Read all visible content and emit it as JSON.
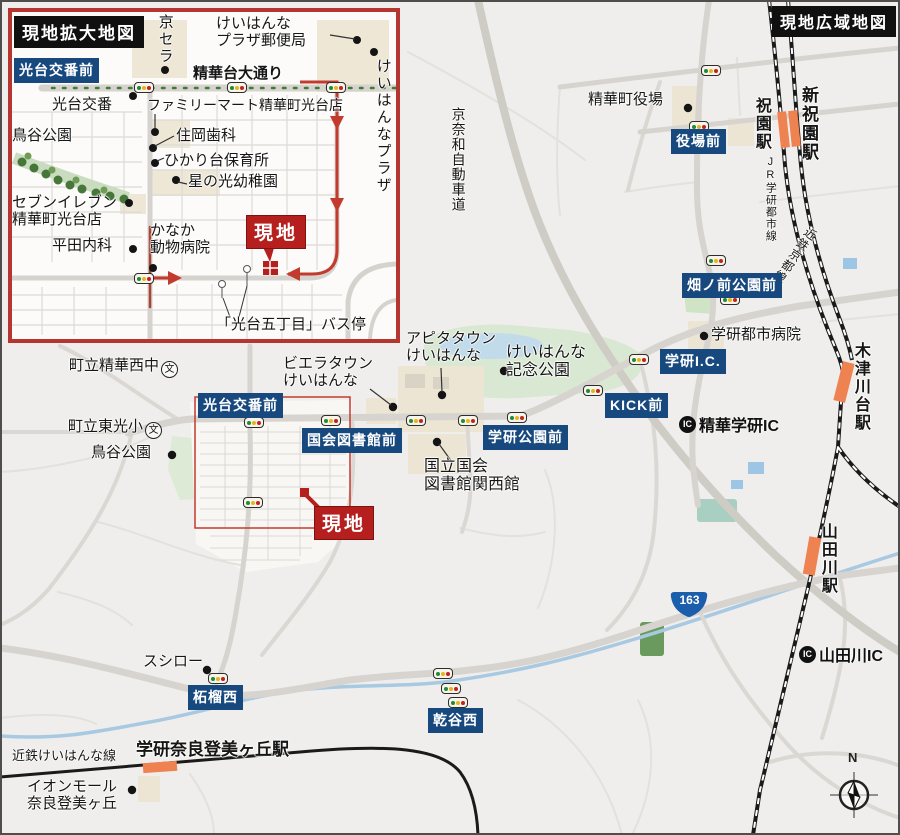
{
  "wide": {
    "title": "現地広域地図",
    "badges": {
      "yakuba": "役場前",
      "hatanomae": "畑ノ前公園前",
      "gakken_ic": "学研I.C.",
      "kick": "KICK前",
      "gakken_koen": "学研公園前",
      "kokkai_toshokan": "国会図書館前",
      "kotai_koban": "光台交番前",
      "zakuro_nishi": "柘榴西",
      "inuidani_nishi": "乾谷西"
    },
    "site_label": "現地",
    "stations": {
      "hosono": "祝園駅",
      "shin_hosono": "新祝園駅",
      "kizugawadai": "木津川台駅",
      "yamadagawa": "山田川駅",
      "gakken_nara_tomigaoka": "学研奈良登美ヶ丘駅"
    },
    "railways": {
      "jr_gakkentoshi": "JR学研都市線",
      "kintetsu_kyoto": "近鉄京都線",
      "kintetsu_keihanna": "近鉄けいはんな線"
    },
    "roads": {
      "keinawa_expressway": "京奈和自動車道",
      "route_number": "163"
    },
    "ic": {
      "mark": "IC",
      "seika_gakken": "精華学研IC",
      "yamadagawa": "山田川IC"
    },
    "pois": {
      "seika_town_hall": "精華町役場",
      "gakken_hospital": "学研都市病院",
      "keihanna_kinen_park": "けいはんな\n記念公園",
      "apita_town": "アピタタウン\nけいはんな",
      "viera_town": "ビエラタウン\nけいはんな",
      "diet_library": "国立国会\n図書館関西館",
      "seika_nishi_jhs": "町立精華西中",
      "toko_es": "町立東光小",
      "toriya_park": "鳥谷公園",
      "sushiro": "スシロー",
      "aeon_mall": "イオンモール\n奈良登美ヶ丘"
    },
    "school_mark": "文",
    "compass_north": "N"
  },
  "inset": {
    "title": "現地拡大地図",
    "badge_kotai_koban": "光台交番前",
    "site_label": "現地",
    "street": "精華台大通り",
    "pois": {
      "kyocera": "京セラ",
      "keihanna_plaza_post": "けいはんな\nプラザ郵便局",
      "kotai_koban": "光台交番",
      "familymart": "ファミリーマート精華町光台店",
      "toriya_park": "鳥谷公園",
      "sumioka_dental": "住岡歯科",
      "hikaridai_nursery": "ひかり台保育所",
      "hoshinohikari_kg": "星の光幼稚園",
      "seven_eleven": "セブンイレブン\n精華町光台店",
      "hirata_clinic": "平田内科",
      "kanaka_vet": "かなか\n動物病院",
      "keihanna_plaza": "けいはんなプラザ",
      "bus_stop": "「光台五丁目」バス停"
    }
  },
  "colors": {
    "badge_blue": "#17497f",
    "site_red": "#b5201f",
    "station_orange": "#ef8251",
    "route_shield_blue": "#1b5eab"
  }
}
